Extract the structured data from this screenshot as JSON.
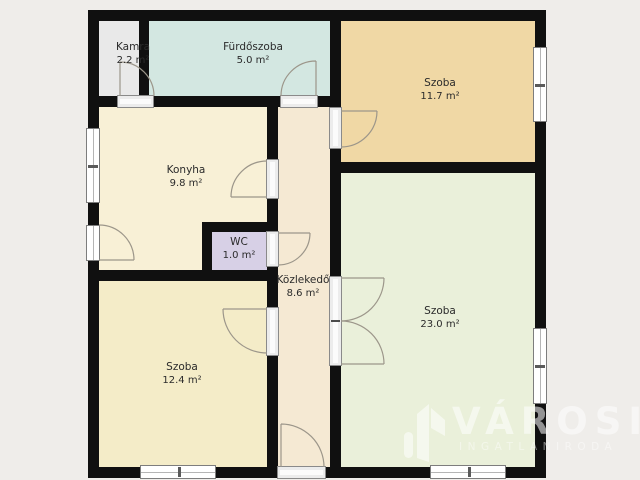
{
  "plan_title": "floor-plan",
  "rooms": [
    {
      "name": "Kamra",
      "area": "2.2 m²",
      "color": "#e9e9e9"
    },
    {
      "name": "Fürdőszoba",
      "area": "5.0 m²",
      "color": "#d3e7e1"
    },
    {
      "name": "Szoba",
      "area": "11.7 m²",
      "color": "#f0d8a5"
    },
    {
      "name": "Konyha",
      "area": "9.8 m²",
      "color": "#f8f0d6"
    },
    {
      "name": "WC",
      "area": "1.0 m²",
      "color": "#d7d0e6"
    },
    {
      "name": "Közlekedő",
      "area": "8.6 m²",
      "color": "#f5e9d3"
    },
    {
      "name": "Szoba",
      "area": "23.0 m²",
      "color": "#eaf0da"
    },
    {
      "name": "Szoba",
      "area": "12.4 m²",
      "color": "#f4ecc8"
    }
  ],
  "watermark": {
    "brand": "VÁROSI",
    "tagline": "INGATLANIRODA"
  },
  "palette": {
    "background": "#efedea",
    "wall": "#101010",
    "window_frame": "#7d7d7d",
    "door_arc": "#9c968a",
    "label_text": "#2b2b2b",
    "watermark_color": "#ffffff"
  }
}
